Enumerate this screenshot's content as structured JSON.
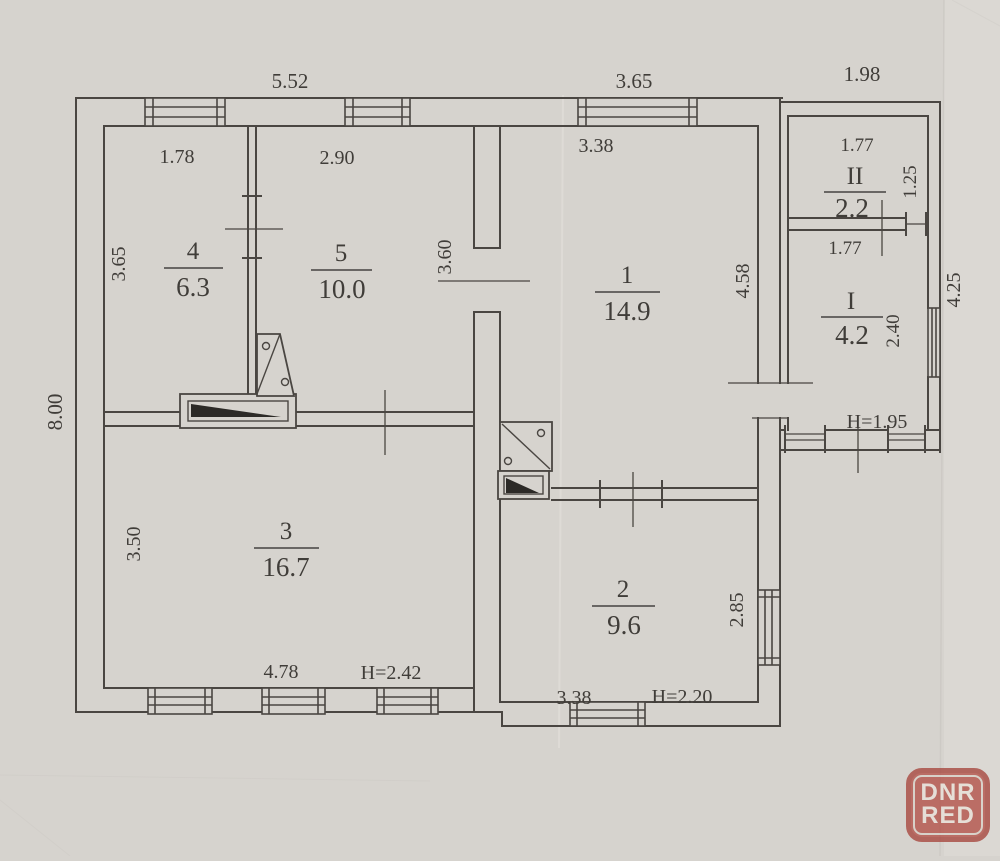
{
  "document": {
    "type": "floor-plan-scan",
    "paper_color": "#d6d3ce",
    "line_color": "#4a4642"
  },
  "overall_dimensions": {
    "top_widths": [
      "5.52",
      "3.65",
      "1.98"
    ],
    "left_height": "8.00",
    "porch_right_height": "4.25"
  },
  "rooms": [
    {
      "number": "4",
      "area": "6.3",
      "top_width": "1.78",
      "left_height": "3.65"
    },
    {
      "number": "5",
      "area": "10.0",
      "top_width": "2.90",
      "right_height": "3.60"
    },
    {
      "number": "1",
      "area": "14.9",
      "top_width": "3.38",
      "right_height": "4.58"
    },
    {
      "number": "2",
      "area": "9.6",
      "bottom_width": "3.38",
      "right_height": "2.85",
      "ceiling_height": "H=2.20"
    },
    {
      "number": "3",
      "area": "16.7",
      "left_height": "3.50",
      "bottom_width": "4.78",
      "ceiling_height": "H=2.42"
    },
    {
      "number": "II",
      "area": "2.2",
      "top_width": "1.77",
      "right_height": "1.25"
    },
    {
      "number": "I",
      "area": "4.2",
      "top_width": "1.77",
      "right_height": "2.40",
      "ceiling_height": "H=1.95"
    }
  ],
  "watermark": {
    "line1": "DNR",
    "line2": "RED",
    "color": "#b4564d"
  }
}
